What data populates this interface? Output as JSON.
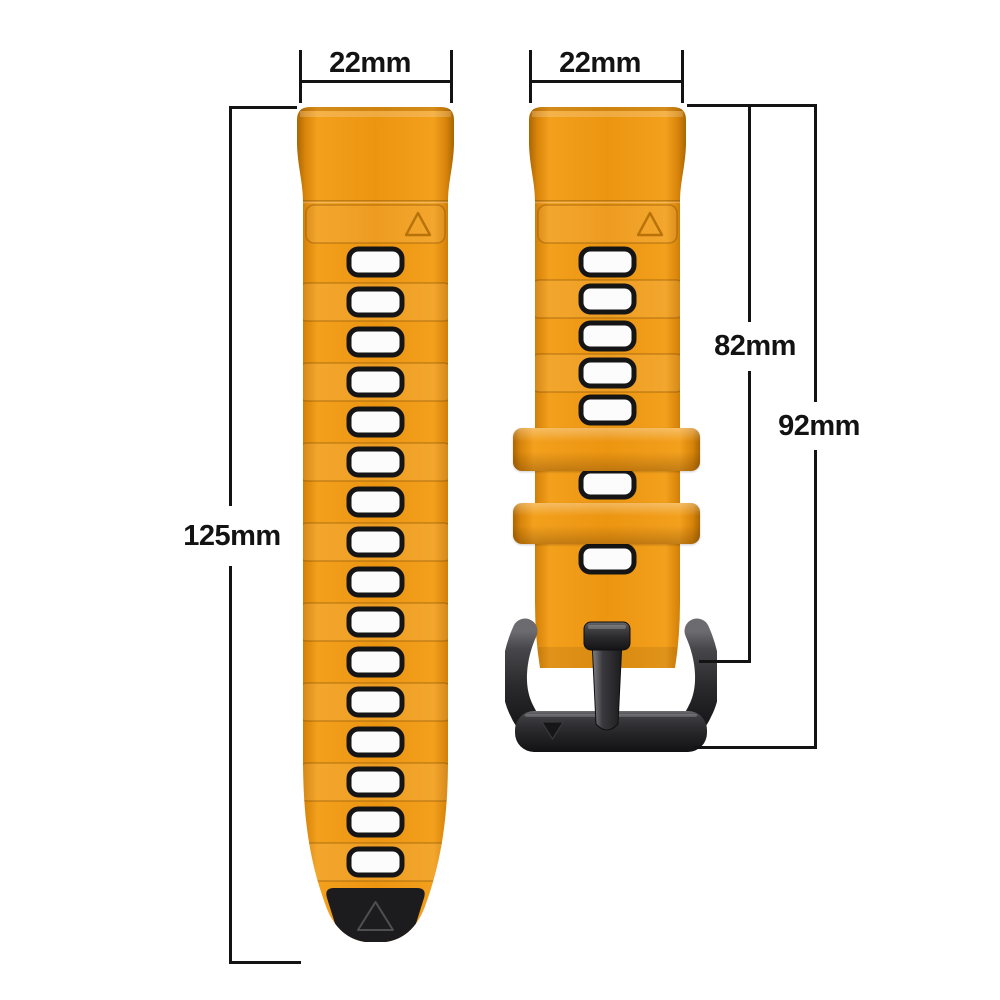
{
  "page": {
    "background_color": "#ffffff",
    "description": "Two-piece silicone quick-release watch strap with black buckle, annotated with size dimensions"
  },
  "dimensions": {
    "left_strap_width": "22mm",
    "right_strap_width": "22mm",
    "left_strap_length": "125mm",
    "right_strap_length_to_buckle_pin": "82mm",
    "right_strap_length_total": "92mm"
  },
  "product": {
    "strap_color_main": "#EC9511",
    "strap_color_edge": "#A96603",
    "strap_highlight": "#F3A01D",
    "hole_fill_color": "#FCFCFC",
    "hole_border_color": "#151515",
    "tip_inlay_color": "#1C1C1E",
    "buckle_color": "#2A2A2D",
    "annotation_line_color": "#131313",
    "left_strap": {
      "hole_count": 16
    },
    "right_strap": {
      "hole_count": 7,
      "keeper_count": 2
    }
  },
  "icons": {
    "left_strap_mark": "triangle-outline-icon",
    "left_tip_mark": "triangle-outline-icon",
    "right_strap_mark": "triangle-outline-icon",
    "buckle_mark": "triangle-down-icon"
  }
}
